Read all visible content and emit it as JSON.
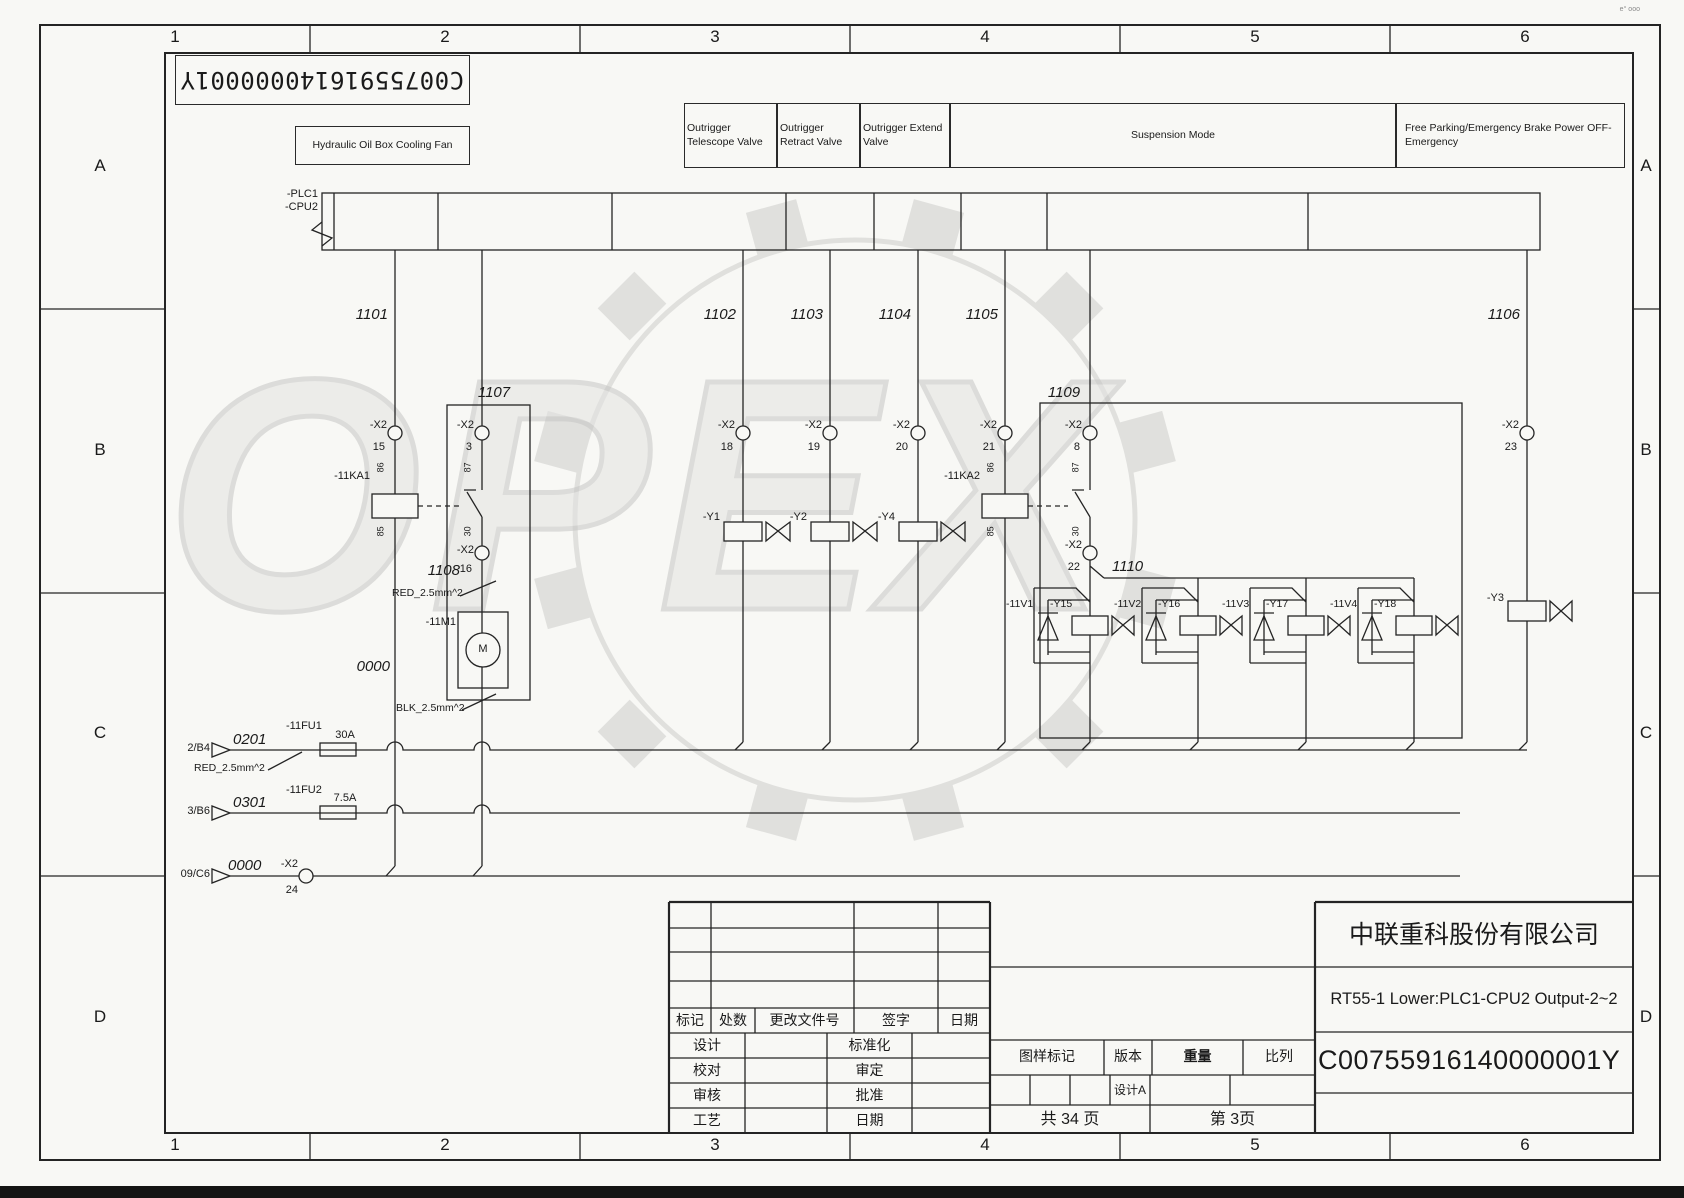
{
  "watermark": {
    "text": "OPEX"
  },
  "corner_mark": "e° ooo",
  "frame": {
    "columns": [
      "1",
      "2",
      "3",
      "4",
      "5",
      "6"
    ],
    "rows": [
      "A",
      "B",
      "C",
      "D"
    ]
  },
  "stamp": {
    "barcode_text": "C00755916140000001Y"
  },
  "function_labels": {
    "cooling_fan": "Hydraulic Oil Box Cooling Fan",
    "outrigger_telescope": "Outrigger Telescope Valve",
    "outrigger_retract": "Outrigger Retract Valve",
    "outrigger_extend": "Outrigger Extend Valve",
    "suspension": "Suspension Mode",
    "free_parking": "Free Parking/Emergency Brake Power OFF-Emergency"
  },
  "plc": {
    "line1": "-PLC1",
    "line2": "-CPU2"
  },
  "nets": {
    "n1101": "1101",
    "n1102": "1102",
    "n1103": "1103",
    "n1104": "1104",
    "n1105": "1105",
    "n1106": "1106",
    "n1107": "1107",
    "n1108": "1108",
    "n1109": "1109",
    "n1110": "1110",
    "n0000": "0000",
    "n0201": "0201",
    "n0301": "0301"
  },
  "x2": {
    "name": "-X2",
    "pins": {
      "p3": "3",
      "p8": "8",
      "p15": "15",
      "p16": "16",
      "p18": "18",
      "p19": "19",
      "p20": "20",
      "p21": "21",
      "p22": "22",
      "p23": "23",
      "p24": "24"
    }
  },
  "relays": {
    "ka1": "-11KA1",
    "ka2": "-11KA2",
    "pin86": "86",
    "pin85": "85",
    "pin87": "87",
    "pin30": "30"
  },
  "motor": {
    "ref": "-11M1",
    "symbol": "M"
  },
  "valves": {
    "y1": "-Y1",
    "y2": "-Y2",
    "y4": "-Y4",
    "y3": "-Y3"
  },
  "units": [
    {
      "diode": "-11V1",
      "valve": "-Y15"
    },
    {
      "diode": "-11V2",
      "valve": "-Y16"
    },
    {
      "diode": "-11V3",
      "valve": "-Y17"
    },
    {
      "diode": "-11V4",
      "valve": "-Y18"
    }
  ],
  "fuses": {
    "fu1": "-11FU1",
    "fu1_rating": "30A",
    "fu2": "-11FU2",
    "fu2_rating": "7.5A"
  },
  "wires": {
    "red": "RED_2.5mm^2",
    "blk": "BLK_2.5mm^2"
  },
  "refs": {
    "r1": "2/B4",
    "r2": "3/B6",
    "r3": "09/C6"
  },
  "titleblock": {
    "company": "中联重科股份有限公司",
    "title": "RT55-1 Lower:PLC1-CPU2 Output-2~2",
    "doc_number": "C00755916140000001Y",
    "rev_header": {
      "mark": "标记",
      "count": "处数",
      "doc_no": "更改文件号",
      "sign": "签字",
      "date": "日期"
    },
    "signoff": {
      "design": "设计",
      "standardize": "标准化",
      "check": "校对",
      "examine": "审定",
      "audit": "审核",
      "approve": "批准",
      "process": "工艺",
      "date": "日期"
    },
    "stamp_header": {
      "mark": "图样标记",
      "version": "版本",
      "weight": "重量",
      "scale": "比列"
    },
    "version_value": "设计A",
    "pages_total": "共 34 页",
    "page_current": "第 3页"
  }
}
